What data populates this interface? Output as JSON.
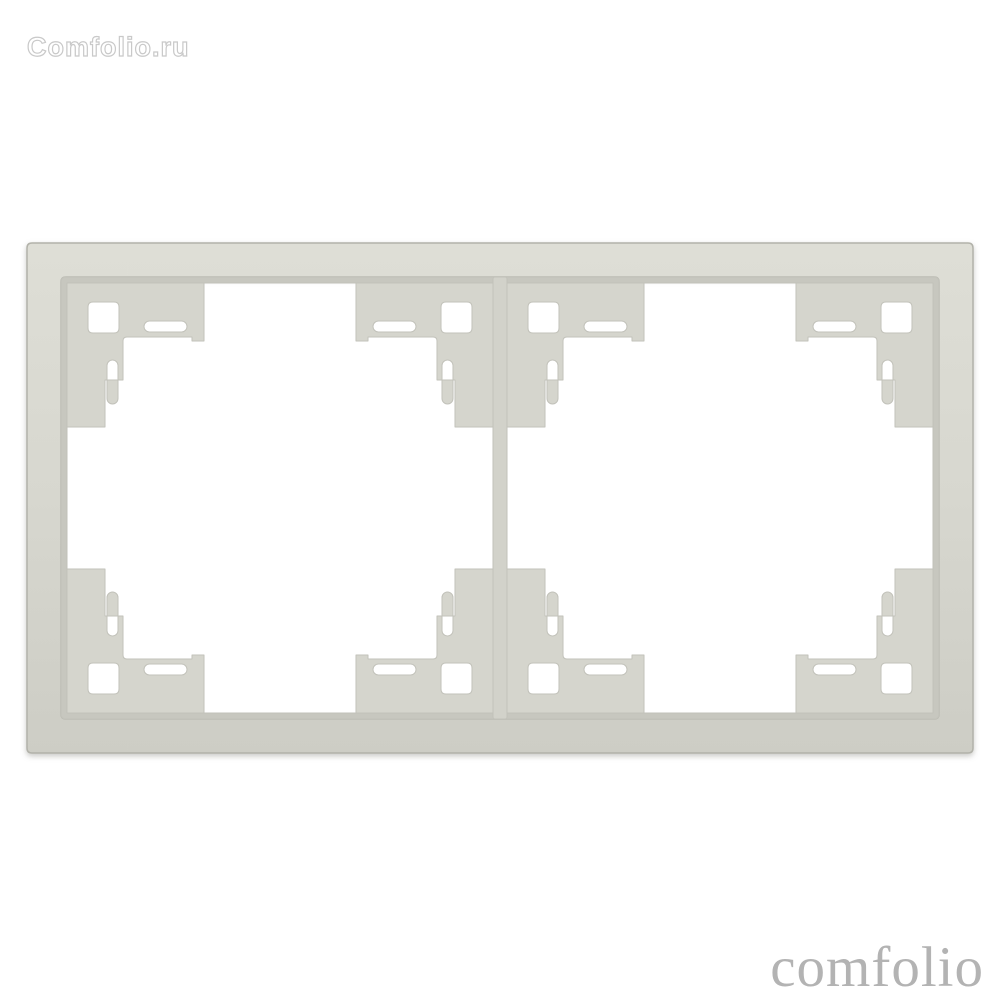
{
  "watermark": {
    "text": "Comfolio.ru",
    "outline_color": "#c9c9c9"
  },
  "brand": {
    "text": "comfolio",
    "color": "#b3b3b3"
  },
  "background_color": "#ffffff",
  "product": {
    "description": "Two-gang wall switch/socket surround frame, light cream plastic, front view on white background",
    "colors": {
      "face_light": "#deded6",
      "face": "#d7d7cf",
      "face_dark": "#cdcdc5",
      "bevel_wall": "#c7c7bf",
      "tab": "#d5d5cd",
      "rib": "#d2d2ca",
      "seam": "#c2c2ba",
      "outline": "#b2b2aa",
      "shadow": "#8a8a82",
      "hole": "#ffffff"
    }
  }
}
